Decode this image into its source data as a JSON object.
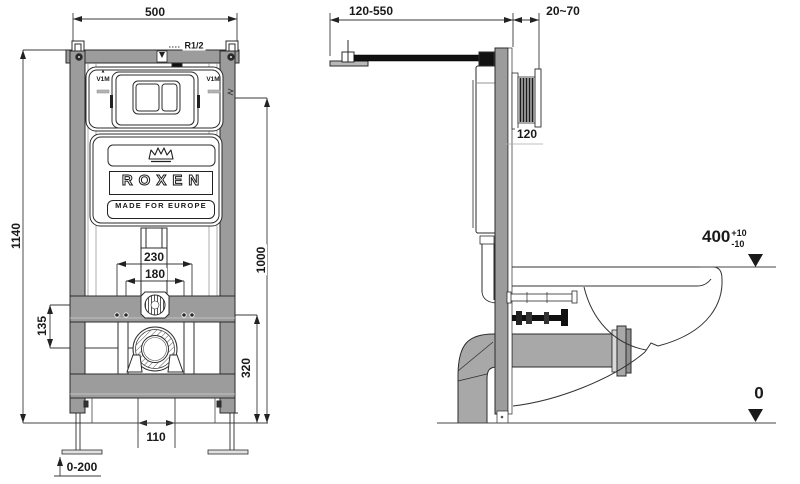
{
  "title": "Wall-hung WC installation frame — technical drawing",
  "front_view": {
    "dim_width_top": "500",
    "dim_height_overall": "1140",
    "water_supply_label": "R1/2",
    "plate_marking_left": "V1M",
    "plate_marking_right": "V1M",
    "plate_marking_icon": "▴",
    "logo_text": "ROXEN",
    "logo_tagline": "MADE FOR EUROPE",
    "dim_fixing_outer": "230",
    "dim_fixing_inner": "180",
    "dim_inlet_offset": "135",
    "dim_plate_center_height": "1000",
    "dim_fixing_height": "320",
    "dim_waste_outlet": "110",
    "dim_leg_adjustment": "0-200"
  },
  "side_view": {
    "dim_wall_bracket_range": "120-550",
    "dim_plate_depth": "20~70",
    "dim_frame_depth": "120",
    "dim_seat_height": "400",
    "seat_tol_plus": "+10",
    "seat_tol_minus": "-10",
    "floor_level": "0"
  },
  "colors": {
    "line": "#2b2b2b",
    "frame_gray": "#9c9c9c",
    "pipe_gray": "#a8a8a8",
    "background": "#ffffff"
  }
}
